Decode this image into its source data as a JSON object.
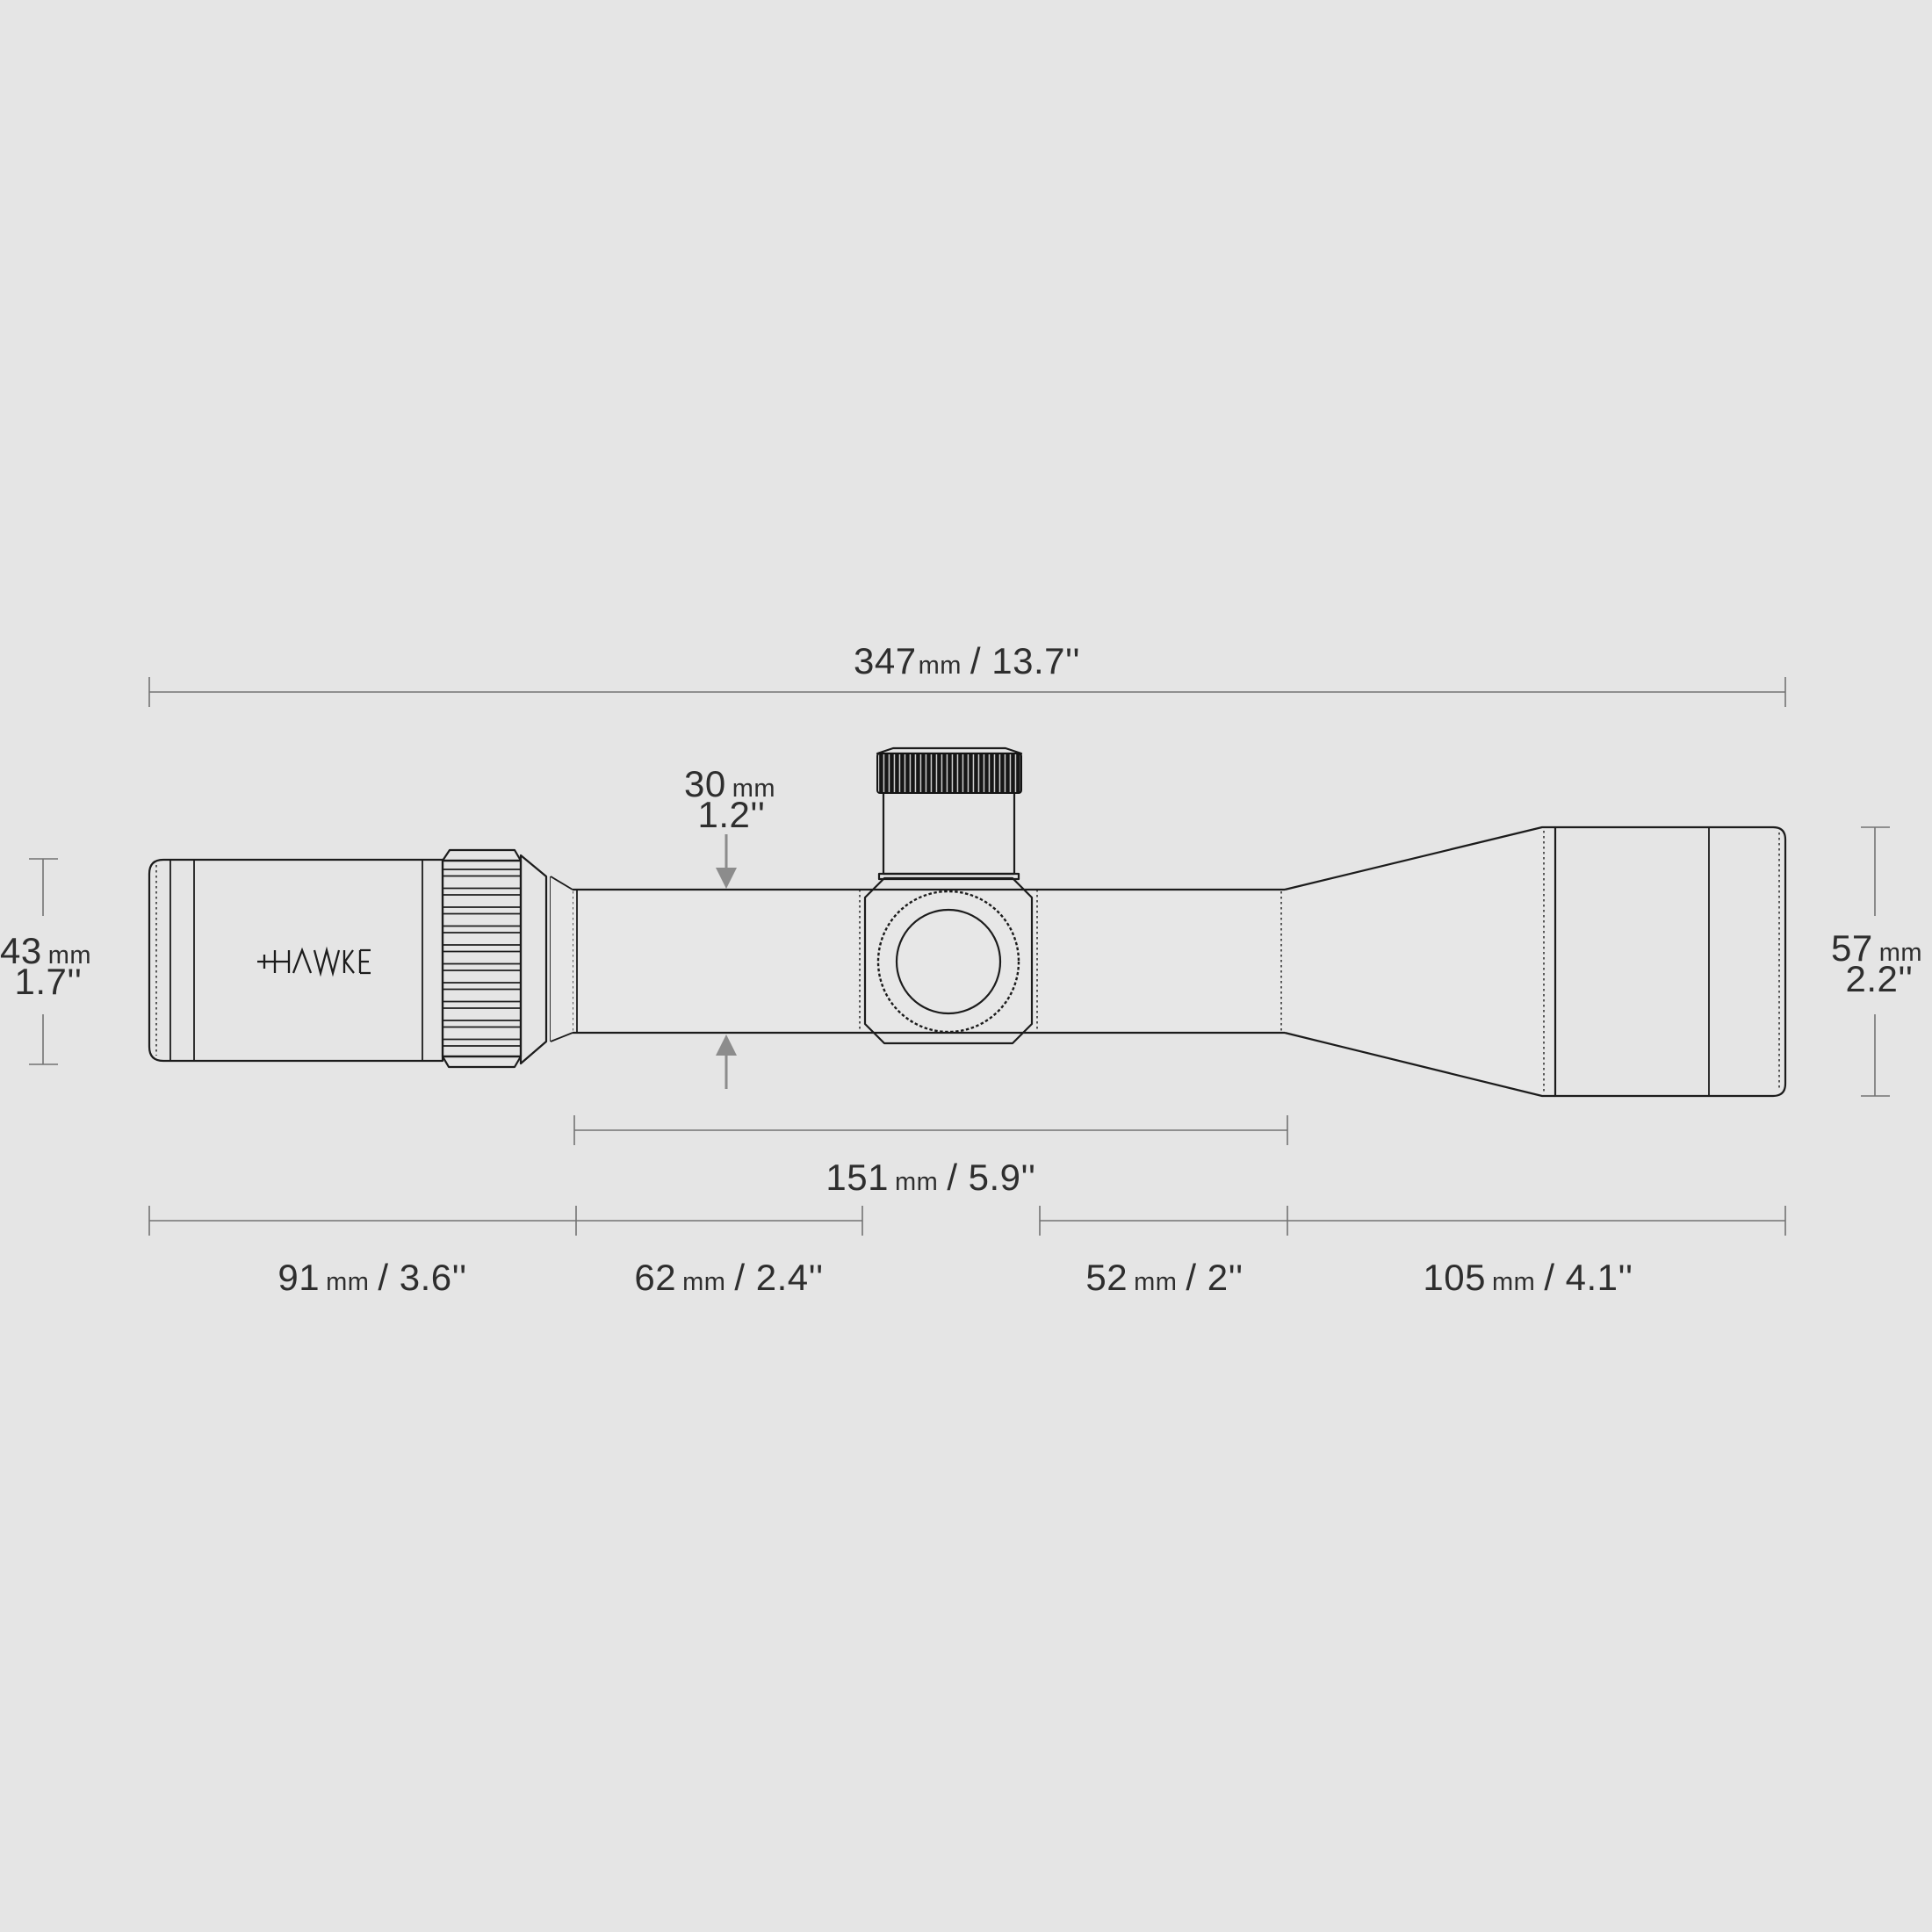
{
  "figure": {
    "brand_logo": "HAWKE",
    "description": "Riflescope dimension diagram (side view)"
  },
  "colors": {
    "bg": "#e5e5e5",
    "line": "#1c1c1c",
    "dim": "#737373",
    "arrow": "#8c8c8c",
    "txt": "#2e2e2e"
  },
  "dims": {
    "total": {
      "num": "347",
      "unit": "mm",
      "inch": "/ 13.7''"
    },
    "tube": {
      "num": "30",
      "unit": "mm",
      "inch": "1.2''"
    },
    "eyepiece": {
      "num": "43",
      "unit": "mm",
      "inch": "1.7''"
    },
    "objective": {
      "num": "57",
      "unit": "mm",
      "inch": "2.2''"
    },
    "mount": {
      "num": "151",
      "unit": "mm",
      "inch": "/ 5.9''"
    },
    "seg91": {
      "num": "91",
      "unit": "mm",
      "inch": "/ 3.6''"
    },
    "seg62": {
      "num": "62",
      "unit": "mm",
      "inch": "/ 2.4''"
    },
    "seg52": {
      "num": "52",
      "unit": "mm",
      "inch": "/ 2''"
    },
    "seg105": {
      "num": "105",
      "unit": "mm",
      "inch": "/ 4.1''"
    }
  }
}
